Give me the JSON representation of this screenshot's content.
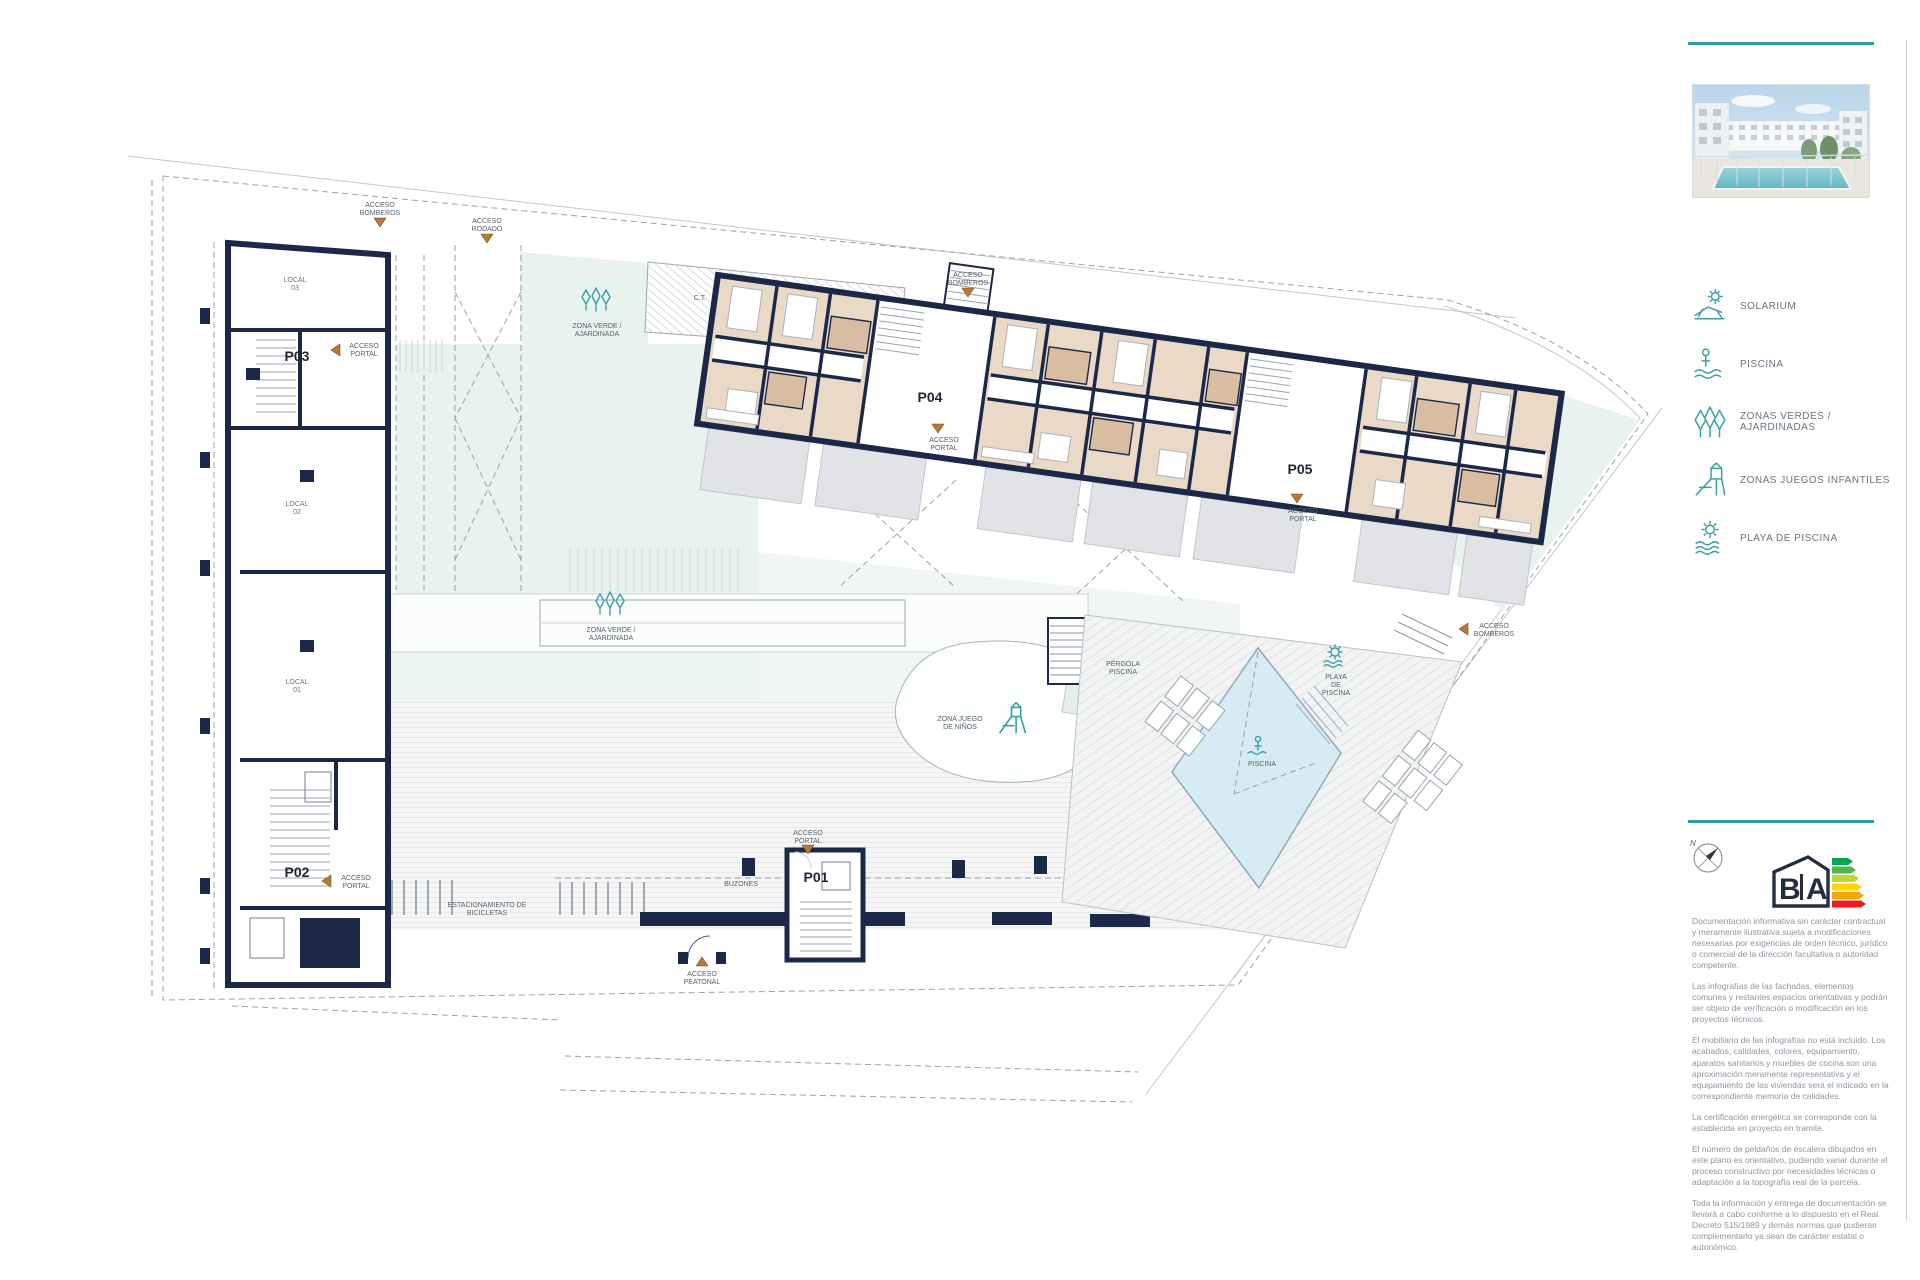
{
  "plan": {
    "labels": {
      "access_bomberos": {
        "l1": "ACCESO",
        "l2": "BOMBEROS"
      },
      "access_rodado": {
        "l1": "ACCESO",
        "l2": "RODADO"
      },
      "access_portal": {
        "l1": "ACCESO",
        "l2": "PORTAL"
      },
      "access_peatonal": {
        "l1": "ACCESO",
        "l2": "PEATONAL"
      },
      "p01": "P01",
      "p02": "P02",
      "p03": "P03",
      "p04": "P04",
      "p05": "P05",
      "local03": {
        "l1": "LOCAL",
        "l2": "03"
      },
      "local02": {
        "l1": "LOCAL",
        "l2": "02"
      },
      "local01": {
        "l1": "LOCAL",
        "l2": "01"
      },
      "zona_verde": {
        "l1": "ZONA VERDE /",
        "l2": "AJARDINADA"
      },
      "ct": "C.T.",
      "zona_juego": {
        "l1": "ZONA JUEGO",
        "l2": "DE NIÑOS"
      },
      "pergola": {
        "l1": "PÉRGOLA",
        "l2": "PISCINA"
      },
      "playa": {
        "l1": "PLAYA",
        "l2": "DE",
        "l3": "PISCINA"
      },
      "piscina": "PISCINA",
      "bicicletas": {
        "l1": "ESTACIONAMIENTO DE",
        "l2": "BICICLETAS"
      },
      "buzones": "BUZONES"
    }
  },
  "sidebar": {
    "legend": {
      "items": [
        {
          "icon": "solarium-icon",
          "label": "SOLARIUM"
        },
        {
          "icon": "pool-icon",
          "label": "PISCINA"
        },
        {
          "icon": "trees-icon",
          "label": "ZONAS VERDES / AJARDINADAS"
        },
        {
          "icon": "playground-icon",
          "label": "ZONAS JUEGOS INFANTILES"
        },
        {
          "icon": "pool-beach-icon",
          "label": "PLAYA DE PISCINA"
        }
      ]
    },
    "compass_n": "N",
    "energy_label": {
      "letter_b": "B",
      "letter_a": "A"
    },
    "disclaimer": {
      "paragraphs": [
        "Documentación informativa sin carácter contractual y meramente ilustrativa sujeta a modificaciones necesarias por exigencias de orden técnico, jurídico o comercial de la dirección facultativa o autoridad competente.",
        "Las infografías de las fachadas, elementos comunes y restantes espacios orientativas y podrán ser objeto de verificación o modificación en los proyectos técnicos.",
        "El mobiliario de las infografías no está incluido. Los acabados, calidades, colores, equipamiento, aparatos sanitarios y muebles de cocina son una aproximación meramente representativa y el equipamiento de las viviendas será el indicado en la correspondiente memoria de calidades.",
        "La certificación energética se corresponde con la establecida en proyecto en tramite.",
        "El número de peldaños de escalera dibujados en este plano es orientativo, pudiendo variar durante el proceso constructivo por necesidades técnicas o adaptación a la topografía real de la parcela.",
        "Toda la información y entrega de documentación se llevará a cabo conforme a lo dispuesto en el Real Decreto 515/1989 y demás normas que pudieran complementarlo ya sean de carácter estatal o autonómico."
      ]
    }
  },
  "colors": {
    "accent_teal": "#2e9ba8",
    "wall_navy": "#1b2848",
    "room_beige": "#ead9c7",
    "bath_tan": "#d8bda3",
    "green_zone": "#e8f2ee",
    "pool_blue": "#d6ebf4",
    "terrace_gray": "#e2e3e6",
    "access_orange": "#b5793a"
  }
}
